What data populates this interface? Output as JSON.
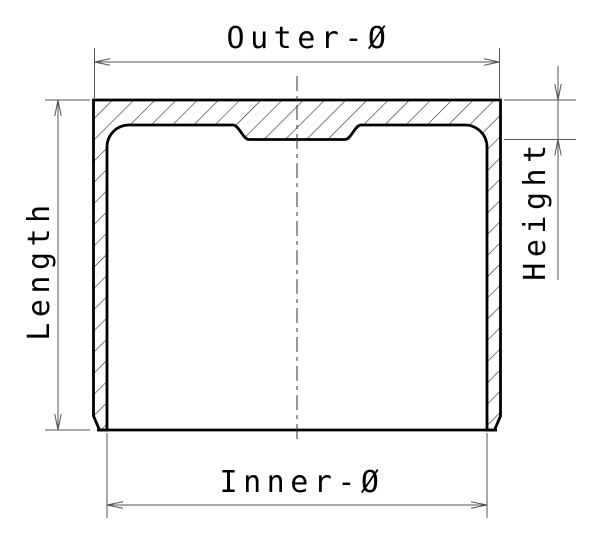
{
  "drawing": {
    "labels": {
      "outer_diameter": "Outer-Ø",
      "inner_diameter": "Inner-Ø",
      "length": "Length",
      "height": "Height"
    },
    "colors": {
      "background": "#ffffff",
      "outline_ink": "#000000",
      "hatch_ink": "#333333",
      "dimension_ink": "#555555",
      "text_ink": "#000000"
    }
  }
}
